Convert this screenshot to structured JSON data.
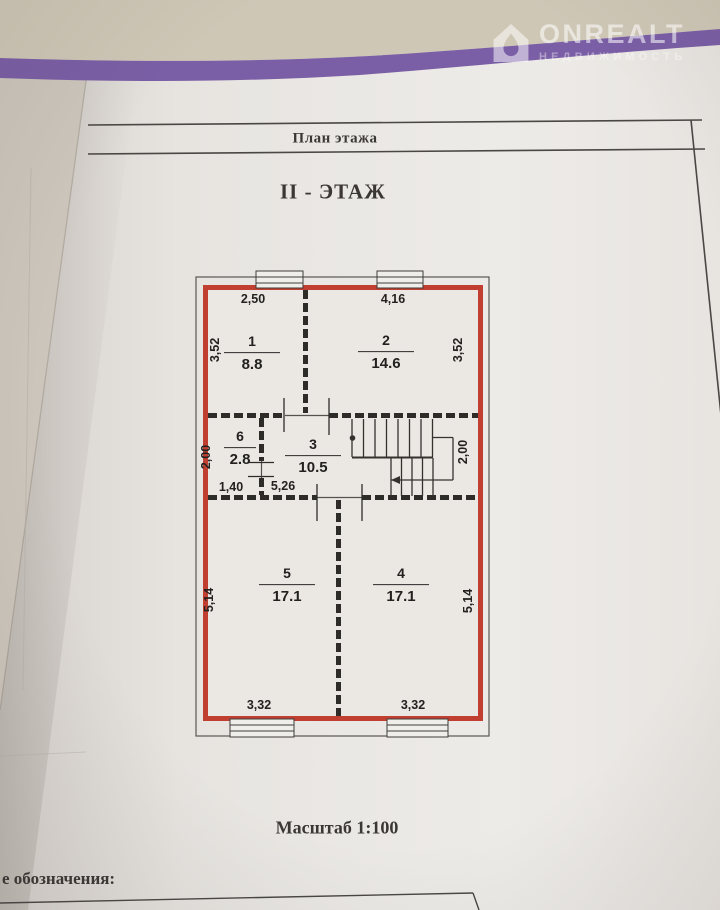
{
  "colors": {
    "ribbon_purple": "#7b5fa6",
    "wall_red": "#c13f31",
    "paper": "#e9e6e2"
  },
  "watermark": {
    "brand": "ONREALT",
    "subtitle": "НЕДВИЖИМОСТЬ"
  },
  "header": {
    "band_label": "План этажа",
    "floor_title": "II - ЭТАЖ"
  },
  "plan": {
    "rooms": [
      {
        "number": "1",
        "area": "8.8"
      },
      {
        "number": "2",
        "area": "14.6"
      },
      {
        "number": "3",
        "area": "10.5"
      },
      {
        "number": "4",
        "area": "17.1"
      },
      {
        "number": "5",
        "area": "17.1"
      },
      {
        "number": "6",
        "area": "2.8"
      }
    ],
    "dims": {
      "top_left": "2,50",
      "top_right": "4,16",
      "side_upper_left": "3,52",
      "side_upper_right": "3,52",
      "mid_left": "2,00",
      "stairs_right": "2,00",
      "room6_width": "1,40",
      "room3_width": "5,26",
      "side_lower_left": "5,14",
      "side_lower_right": "5,14",
      "bottom_left": "3,32",
      "bottom_right": "3,32"
    }
  },
  "footer": {
    "scale": "Масштаб 1:100",
    "legend_partial": "е обозначения:"
  }
}
